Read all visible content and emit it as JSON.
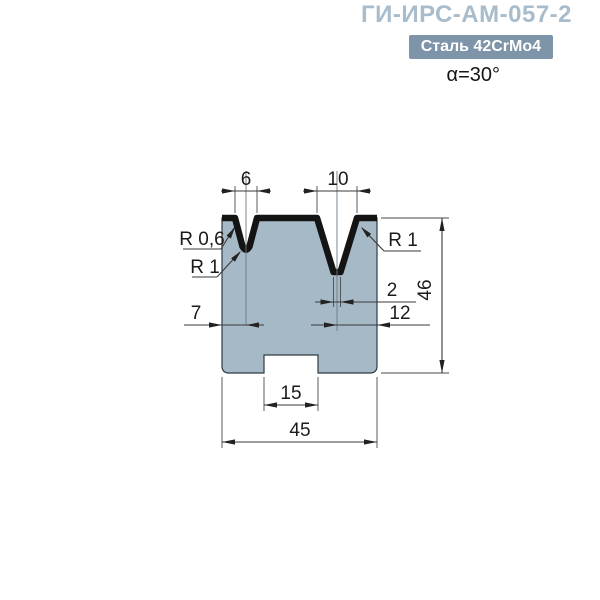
{
  "header": {
    "title": "ГИ-ИРС-АМ-057-2",
    "material_badge": "Сталь 42CrMo4",
    "angle_label": "α=30°"
  },
  "drawing": {
    "labels": {
      "v1_width": "6",
      "v2_width": "10",
      "body_height": "46",
      "v2_flat": "2",
      "v1_offset": "7",
      "v2_offset": "12",
      "slot_width": "15",
      "body_width": "45",
      "radius_top_left": "R 0,6",
      "radius_v1_bottom": "R 1",
      "radius_top_right": "R 1"
    },
    "colors": {
      "body_fill": "#a6b9c7",
      "working_edge": "#141414",
      "accent_title": "#a8bccb",
      "badge_bg": "#7e94a8"
    }
  }
}
